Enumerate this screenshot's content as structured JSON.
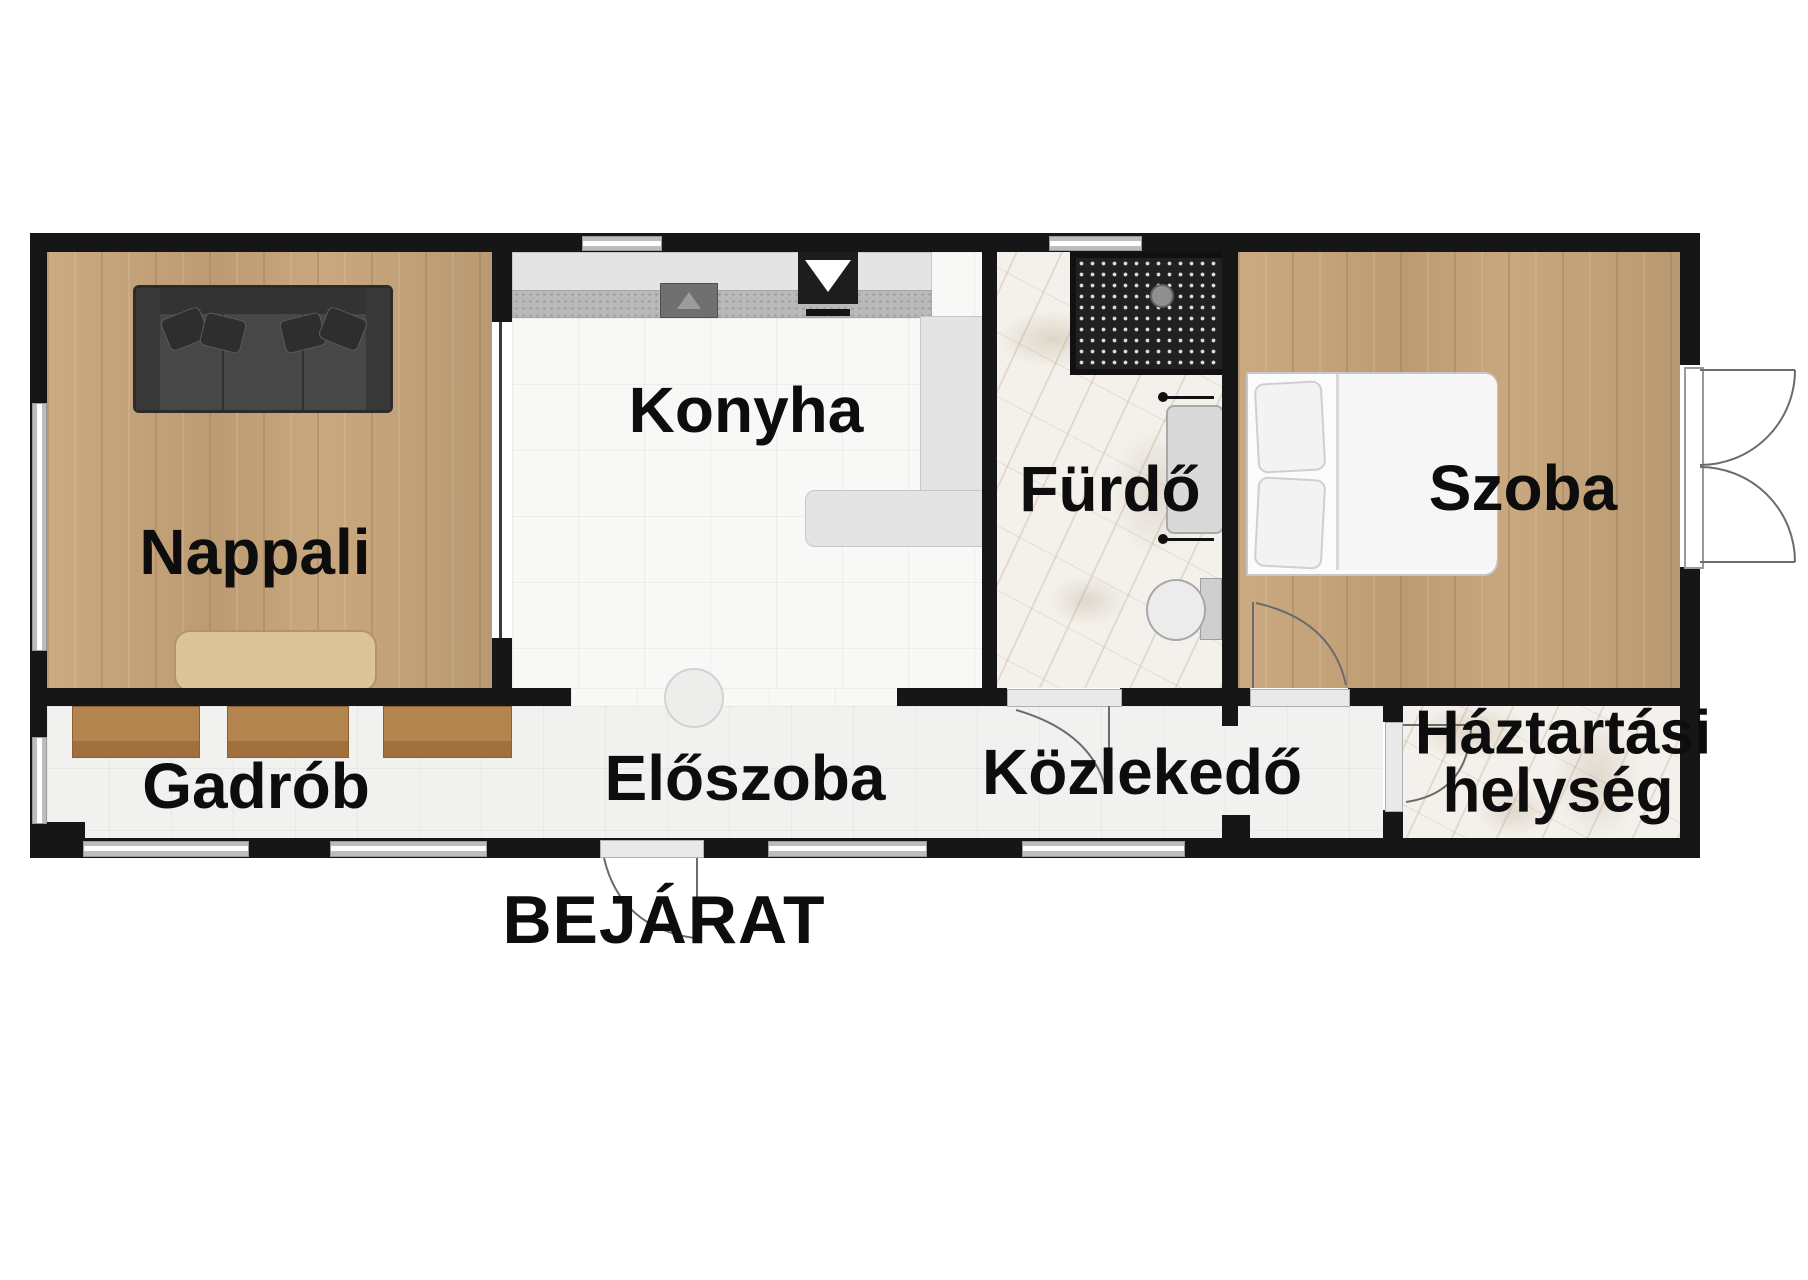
{
  "document": {
    "type": "floor-plan",
    "language": "hu"
  },
  "rooms": {
    "nappali": {
      "label": "Nappali",
      "floor": "wood"
    },
    "konyha": {
      "label": "Konyha",
      "floor": "white-tile"
    },
    "furdo": {
      "label": "Fürdő",
      "floor": "marble"
    },
    "szoba": {
      "label": "Szoba",
      "floor": "wood"
    },
    "gadrob": {
      "label": "Gadrób",
      "floor": "light-tile"
    },
    "eloszoba": {
      "label": "Előszoba",
      "floor": "light-tile"
    },
    "kozlekedo": {
      "label": "Közlekedő",
      "floor": "light-tile"
    },
    "haztartasi": {
      "line1": "Háztartási",
      "line2": "helység",
      "floor": "marble"
    }
  },
  "entrance": {
    "label": "BEJÁRAT"
  },
  "palette": {
    "wall": "#161616",
    "wood": "#c7a67e",
    "marble": "#f4f1ec",
    "tile_white": "#f8f8f7",
    "tile_light": "#f1f1ef",
    "window_gray": "#bdbdbd",
    "wardrobe": "#b5854f",
    "sofa": "#474747",
    "counter": "#dedede"
  }
}
